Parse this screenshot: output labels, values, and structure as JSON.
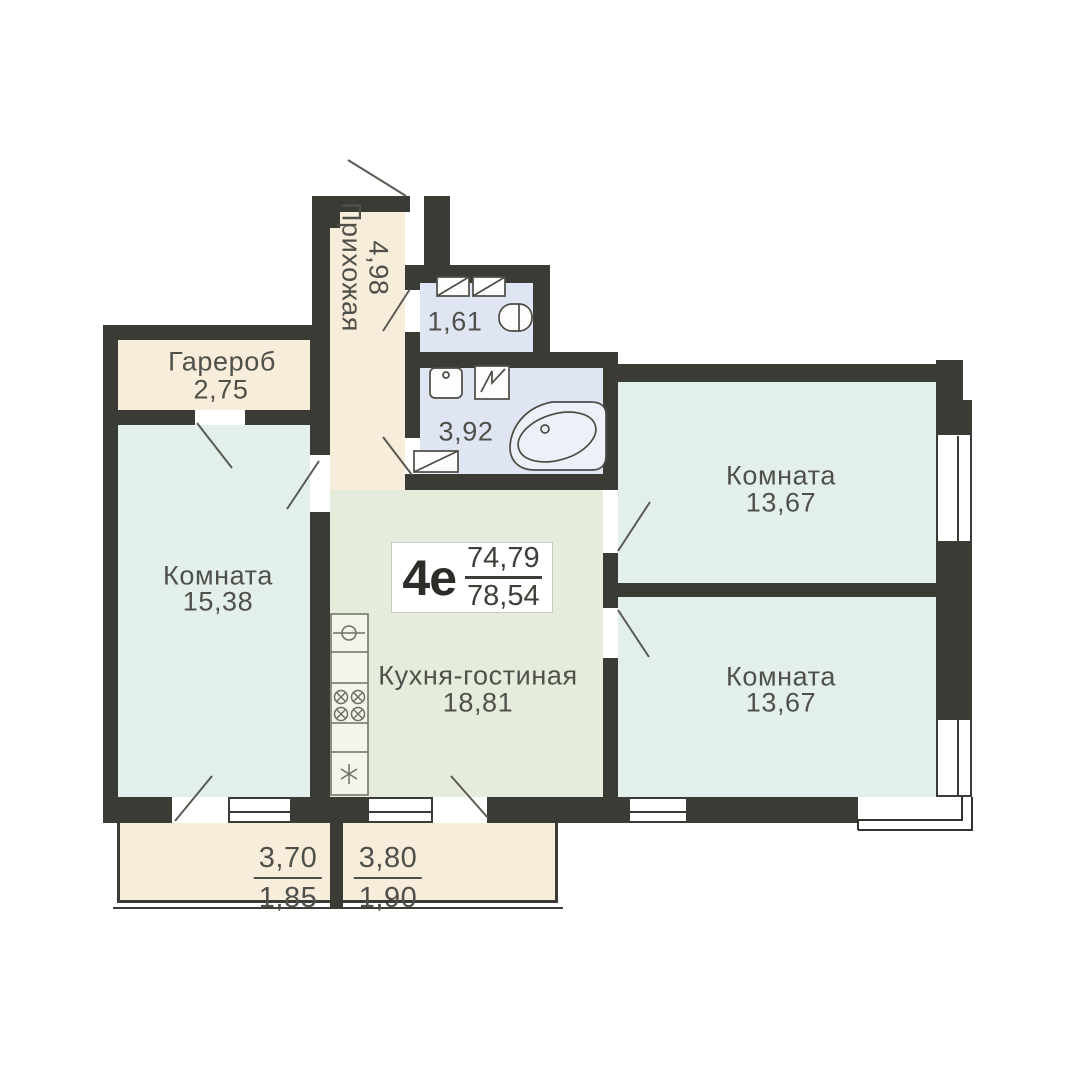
{
  "plan": {
    "unit": {
      "label": "4е",
      "area_living": "74,79",
      "area_total": "78,54"
    },
    "rooms": {
      "hallway": {
        "name": "Прихожая",
        "area": "4,98"
      },
      "wardrobe": {
        "name": "Гарероб",
        "area": "2,75"
      },
      "wc": {
        "area": "1,61"
      },
      "bathroom": {
        "area": "3,92"
      },
      "room_left": {
        "name": "Комната",
        "area": "15,38"
      },
      "kitchen": {
        "name": "Кухня-гостиная",
        "area": "18,81"
      },
      "room_top_right": {
        "name": "Комната",
        "area": "13,67"
      },
      "room_bottom_right": {
        "name": "Комната",
        "area": "13,67"
      }
    },
    "balconies": {
      "left": {
        "full": "3,70",
        "reduced": "1,85"
      },
      "right": {
        "full": "3,80",
        "reduced": "1,90"
      }
    },
    "colors": {
      "wall": "#3b3b35",
      "hall_beige": "#f8ecdb",
      "room_mint": "#e3efeb",
      "kitchen_sage": "#e6ecdc",
      "bath_lavender": "#dfe5f3",
      "label_ink": "#50504a",
      "unit_ink": "#2c2c28"
    }
  }
}
